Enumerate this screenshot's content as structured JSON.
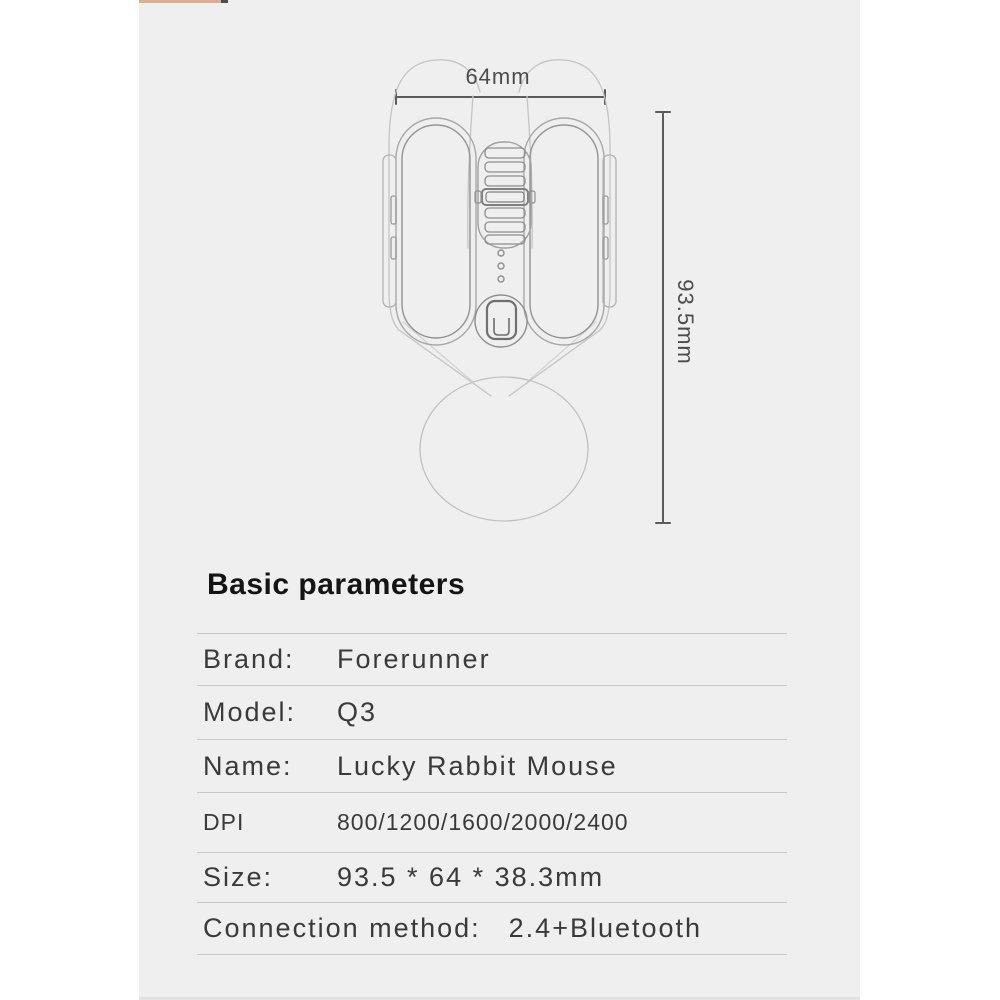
{
  "header": {
    "title": "Basic parameters"
  },
  "diagram": {
    "width_dimension": "64mm",
    "height_dimension": "93.5mm"
  },
  "spec_table": {
    "rows": [
      {
        "label": "Brand:",
        "value": "Forerunner"
      },
      {
        "label": "Model:",
        "value": "Q3"
      },
      {
        "label": "Name:",
        "value": "Lucky Rabbit Mouse"
      },
      {
        "label": "DPI",
        "value": "800/1200/1600/2000/2400"
      },
      {
        "label": "Size:",
        "value": "93.5 * 64 * 38.3mm"
      },
      {
        "label": "Connection method:",
        "value": "2.4+Bluetooth"
      }
    ]
  },
  "colors": {
    "page_background": "#ffffff",
    "panel_background": "#efefef",
    "divider": "#c7c7c7",
    "dimension_line": "#5c5c5c",
    "outline": "#b0b0b0",
    "text_primary": "#3a3a3a"
  }
}
